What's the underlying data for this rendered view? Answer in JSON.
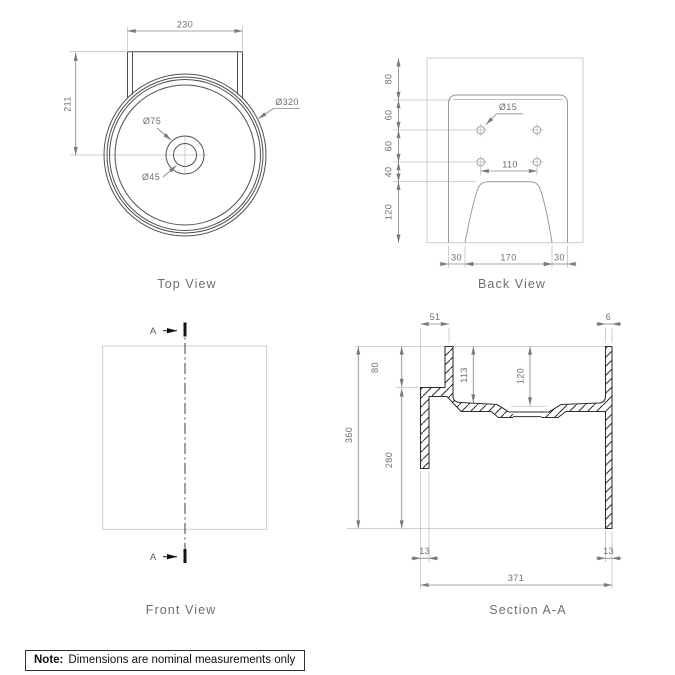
{
  "views": {
    "top": {
      "title": "Top View",
      "dim_width": "230",
      "dim_height": "211",
      "dia_outer": "Ø320",
      "dia_overflow": "Ø75",
      "dia_drain": "Ø45"
    },
    "back": {
      "title": "Back View",
      "dia_holes": "Ø15",
      "dim_hole_spacing": "110",
      "chain_left": [
        "80",
        "60",
        "60",
        "40",
        "120"
      ],
      "chain_bottom": [
        "30",
        "170",
        "30"
      ]
    },
    "front": {
      "title": "Front View",
      "section_marker": "A"
    },
    "section": {
      "title": "Section A-A",
      "dim_back_rim": "51",
      "dim_front_rim": "6",
      "dim_height": "360",
      "dim_rim_drop": "80",
      "dim_lower": "280",
      "dim_depth_back": "113",
      "dim_depth_center": "120",
      "dim_wall_left": "13",
      "dim_wall_right": "13",
      "dim_width": "371"
    }
  },
  "note": {
    "label": "Note:",
    "text": "Dimensions are nominal measurements only"
  },
  "colors": {
    "geometry": "#4f4f4f",
    "secondary": "#9a9a9a",
    "construction": "#c2c2c2",
    "dimension": "#8a8a8a",
    "dim_text": "#6e6e6e",
    "hatch": "#2e2e2e",
    "note_text": "#0f0f0f"
  }
}
